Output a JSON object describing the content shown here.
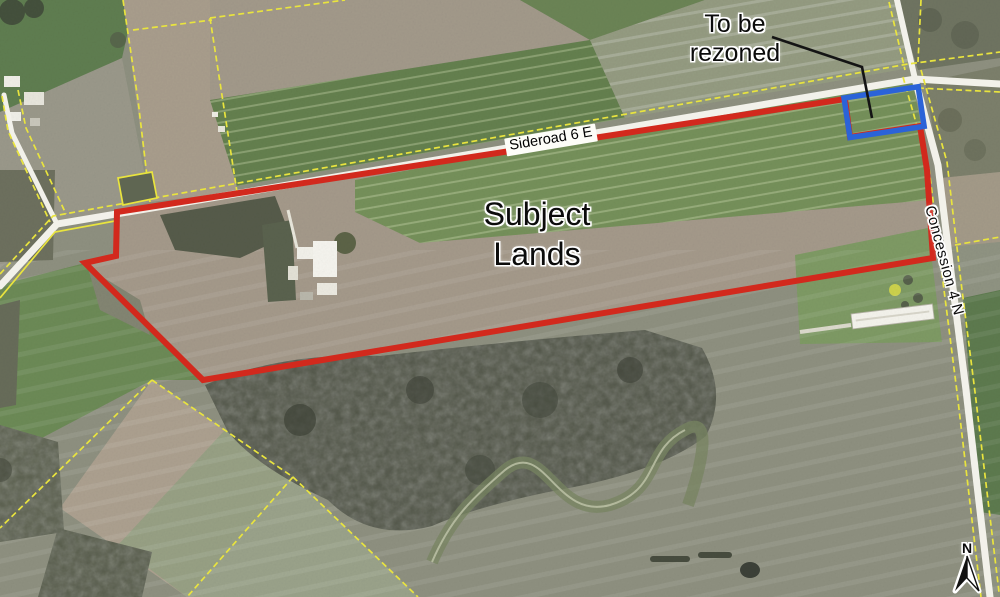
{
  "map": {
    "title": "Aerial photo of subject lands with zoning annotations",
    "labels": {
      "rezone_line1": "To be",
      "rezone_line2": "rezoned",
      "subject_line1": "Subject",
      "subject_line2": "Lands",
      "road_horizontal": "Sideroad 6 E",
      "road_vertical": "Concession 4 N",
      "north": "N"
    },
    "colors": {
      "boundary_red": "#d2291d",
      "rezone_blue": "#2b63d8",
      "parcel_yellow": "#e9e43e",
      "road_white": "#f2f1ea",
      "leader_black": "#141414"
    }
  }
}
